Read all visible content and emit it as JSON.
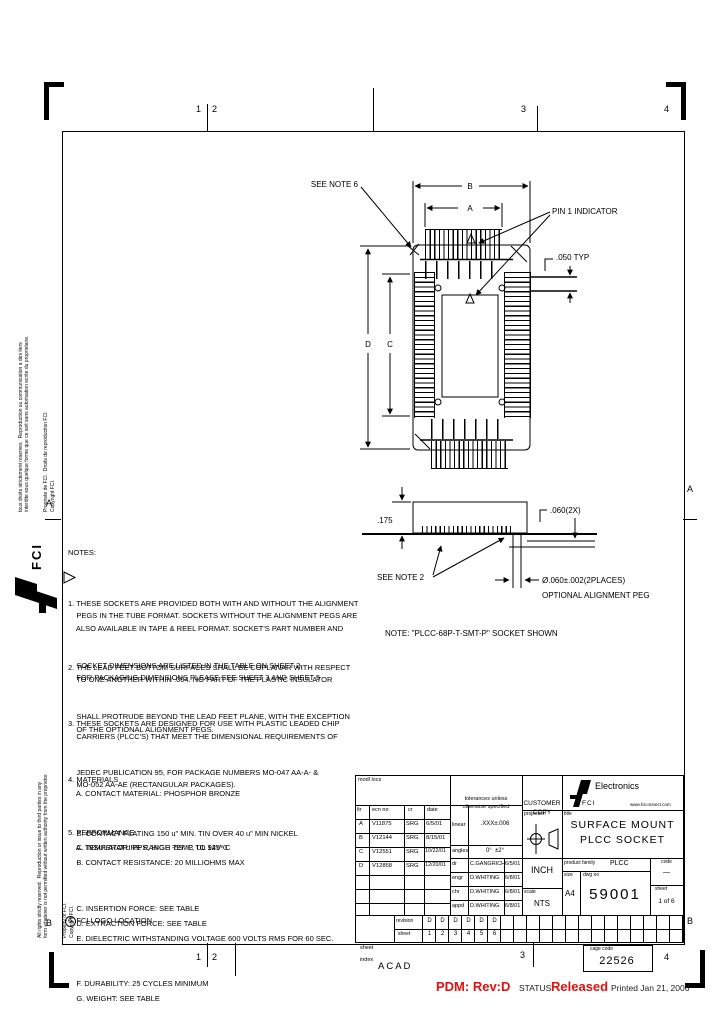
{
  "zones": {
    "t1": "1",
    "t2": "2",
    "t3": "3",
    "t4": "4",
    "b1": "1",
    "b2": "2",
    "b3": "3",
    "b4": "4",
    "la": "A",
    "lb": "B",
    "ra": "A",
    "rb": "B"
  },
  "margin": {
    "fr1": "tous droits strictement reserves.  Reproduction ou communication a des tiers",
    "fr2": "interdite sous quelque forme que ce soit sans autorisation ecrite du proprietaire.",
    "fr3": "Propriete de FCI.  Droits de reproduction FCI.",
    "fr4": "Copyright FCI.",
    "en1": "All rights strictly reserved.  Reproduction or issue to third parties in any",
    "en2": "form whatever is not permitted without written authority from the proprietor.",
    "en3": "Property of FCI.",
    "en4": "Copyright FCI.",
    "fci": "FCI"
  },
  "top_view": {
    "see_note": "SEE NOTE 6",
    "dim_b": "B",
    "dim_a": "A",
    "pin1": "PIN 1 INDICATOR",
    "typ": ".050 TYP",
    "dim_d": "D",
    "dim_c": "C"
  },
  "side_view": {
    "height": ".175",
    "peg_len": ".060(2X)",
    "see_note": "SEE NOTE 2",
    "peg_dia": "Ø.060±.002(2PLACES)",
    "peg_opt": "OPTIONAL ALIGNMENT PEG",
    "caption": "NOTE: \"PLCC-68P-T-SMT-P\" SOCKET SHOWN"
  },
  "notes": {
    "heading": "NOTES:",
    "n1": [
      "1. THESE SOCKETS ARE PROVIDED BOTH WITH AND WITHOUT THE ALIGNMENT",
      "    PEGS IN THE TUBE FORMAT. SOCKETS WITHOUT THE ALIGNMENT PEGS ARE",
      "    ALSO AVAILABLE IN TAPE & REEL FORMAT. SOCKET'S PART NUMBER AND",
      "    SOCKET DIMENSIONS ARE LISTED IN THE TABLE ON SHEET 2.",
      "    FOR PACKAGING DIMENSIONS PLEASE SEE SHEET 3 AND SHEET 5"
    ],
    "n2": [
      "2. THE LEAD FEET BOTTOM SURFACES SHALL BE COPLANAR WITH RESPECT",
      "    TO ONE ANOTHER WITHIN .004. NO PART OF THE PLASTIC INSULATOR",
      "    SHALL PROTRUDE BEYOND THE LEAD FEET PLANE, WITH THE EXCEPTION",
      "    OF THE OPTIONAL ALIGNMENT PEGS."
    ],
    "n3": [
      "3. THESE SOCKETS ARE DESIGNED FOR USE WITH PLASTIC LEADED CHIP",
      "    CARRIERS (PLCC'S) THAT MEET THE DIMENSIONAL REQUIREMENTS OF",
      "    JEDEC PUBLICATION 95, FOR PACKAGE NUMBERS MO-047 AA-A- &",
      "    MO-052 AA-AE (RECTANGULAR PACKAGES)."
    ],
    "n4": [
      "4. MATERIALS",
      "    A. CONTACT MATERIAL: PHOSPHOR BRONZE",
      "    B. CONTACT PLATING 150 u\" MIN. TIN OVER 40 u\" MIN NICKEL",
      "    C. INSULATOR: PPS, HIGH TEMP, UL 94V-0"
    ],
    "n5": [
      "5. PERFORMANCE",
      "    A. TEMPERATURE RANGE -55° C TO 125° C",
      "    B. CONTACT RESISTANCE: 20 MILLIOHMS MAX",
      "    C. INSERTION FORCE: SEE TABLE",
      "    D. EXTRACTION FORCE: SEE TABLE",
      "    E. DIELECTRIC WITHSTANDING VOLTAGE 600 VOLTS RMS FOR 60 SEC.",
      "    F. DURABILITY: 25 CYCLES MINIMUM",
      "    G. WEIGHT: SEE TABLE"
    ],
    "n6": "6. FCI LOGO LOCATION"
  },
  "title_block": {
    "mod_locs": "modl locs",
    "rev_headers": {
      "ltr": "ltr",
      "ecn": "ecn no",
      "cr": "cr",
      "date": "date"
    },
    "revs": [
      {
        "ltr": "A",
        "ecn": "V11875",
        "cr": "SRG",
        "date": "6/5/01"
      },
      {
        "ltr": "B",
        "ecn": "V12144",
        "cr": "SRG",
        "date": "8/15/01"
      },
      {
        "ltr": "C",
        "ecn": "V12551",
        "cr": "SRG",
        "date": "10/22/01"
      },
      {
        "ltr": "D",
        "ecn": "V12858",
        "cr": "SRG",
        "date": "12/20/01"
      }
    ],
    "tol1": "tolerances unless",
    "tol2": "otherwise specified",
    "linear_label": "linear",
    "linear_value": ".XXX±.006",
    "angles_label": "angles",
    "angles_value": "0°  ±2°",
    "approvals": [
      {
        "role": "dr",
        "name": "C.GANGRICH",
        "date": "6/5/01"
      },
      {
        "role": "engr",
        "name": "D.WHITING",
        "date": "6/8/01"
      },
      {
        "role": "chr",
        "name": "D.WHITING",
        "date": "6/8/01"
      },
      {
        "role": "appd",
        "name": "D.WHITING",
        "date": "6/8/01"
      }
    ],
    "customer1": "CUSTOMER",
    "customer2": "COPY",
    "projection_label": "projection",
    "units": "INCH",
    "scale_label": "scale",
    "scale_value": "NTS",
    "brand": {
      "name": "Electronics",
      "abbr": "FCI",
      "site": "www.fciconnect.com"
    },
    "title_label": "title",
    "title1": "SURFACE MOUNT",
    "title2": "PLCC SOCKET",
    "pf_label": "product family",
    "pf_value": "PLCC",
    "code_label": "code",
    "code_value": "—",
    "size_label": "size",
    "size_value": "A4",
    "dwg_label": "dwg no",
    "dwg_no": "59001",
    "sheet_label": "sheet",
    "sheet_value": "1 of 6",
    "index": {
      "col1": "sheet",
      "col2": "index",
      "row1_label": "revision",
      "row2_label": "sheet",
      "revisions": [
        "D",
        "D",
        "D",
        "D",
        "D",
        "D"
      ],
      "sheets": [
        "1",
        "2",
        "3",
        "4",
        "5",
        "6"
      ]
    }
  },
  "footer": {
    "acad": "ACAD",
    "pdm": "PDM: Rev:D",
    "status_label": "STATUS:",
    "status_value": "Released",
    "printed": "Printed Jan 21, 2006",
    "cage_label": "cage code",
    "cage_code": "22526"
  }
}
